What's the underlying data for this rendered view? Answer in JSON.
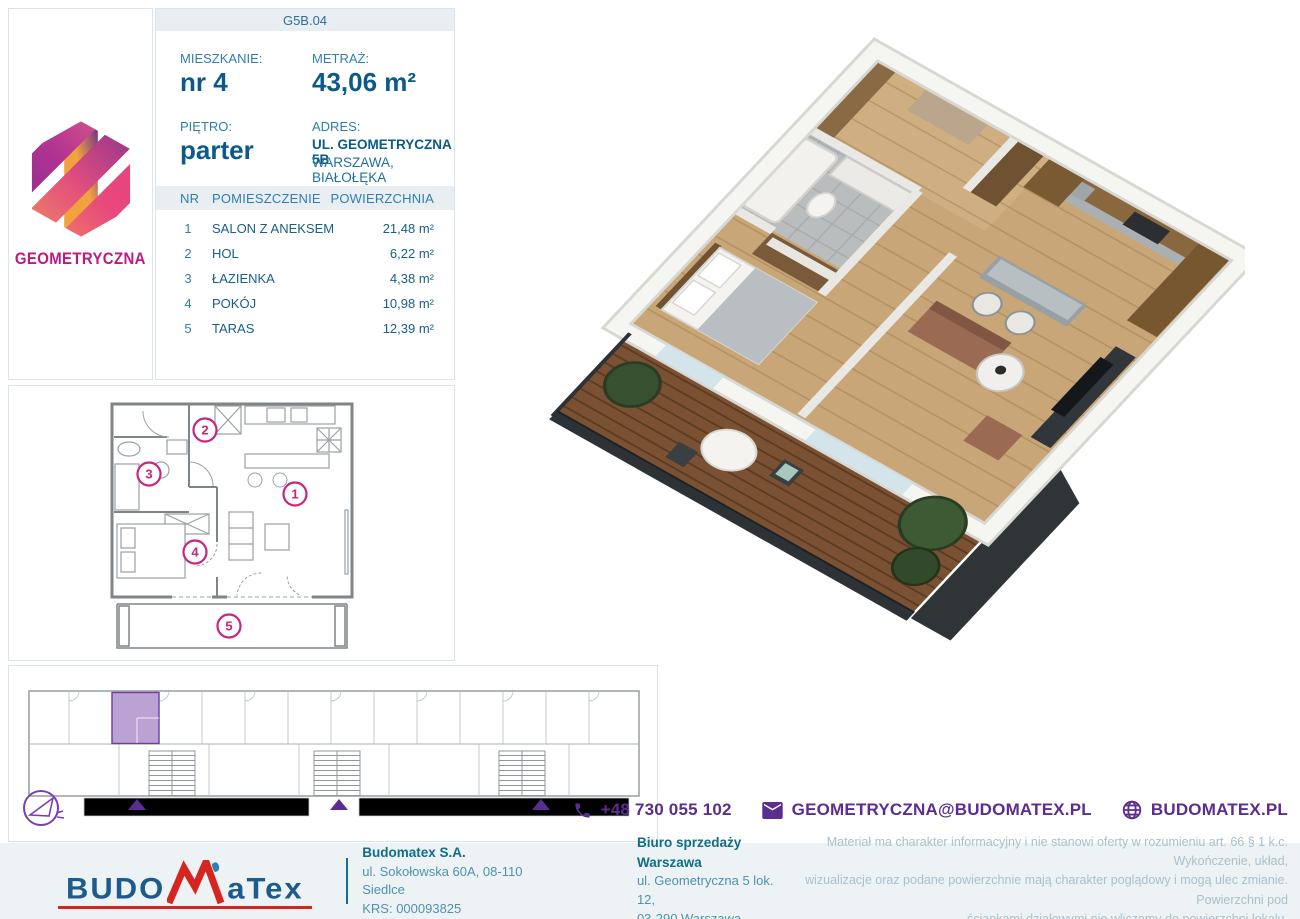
{
  "brand": {
    "name": "GEOMETRYCZNA"
  },
  "unit": {
    "code": "G5B.04",
    "apartment_label": "MIESZKANIE:",
    "apartment_value": "nr 4",
    "area_label": "METRAŻ:",
    "area_value": "43,06 m²",
    "floor_label": "PIĘTRO:",
    "floor_value": "parter",
    "address_label": "ADRES:",
    "address_line1": "UL. GEOMETRYCZNA 5B",
    "address_line2": "WARSZAWA, BIAŁOŁĘKA"
  },
  "rooms": {
    "headers": {
      "nr": "NR",
      "name": "POMIESZCZENIE",
      "area": "POWIERZCHNIA"
    },
    "rows": [
      {
        "nr": "1",
        "name": "SALON Z ANEKSEM",
        "area": "21,48 m²"
      },
      {
        "nr": "2",
        "name": "HOL",
        "area": "6,22 m²"
      },
      {
        "nr": "3",
        "name": "ŁAZIENKA",
        "area": "4,38 m²"
      },
      {
        "nr": "4",
        "name": "POKÓJ",
        "area": "10,98 m²"
      },
      {
        "nr": "5",
        "name": "TARAS",
        "area": "12,39 m²"
      }
    ]
  },
  "plan2d": {
    "markers": [
      "1",
      "2",
      "3",
      "4",
      "5"
    ]
  },
  "contact": {
    "phone": "+48 730 055 102",
    "email": "GEOMETRYCZNA@BUDOMATEX.PL",
    "website": "BUDOMATEX.PL"
  },
  "footer": {
    "logo_left": "BUDO",
    "logo_right": "aTex",
    "company_name": "Budomatex S.A.",
    "company_address": "ul. Sokołowska 60A, 08-110 Siedlce",
    "company_krs": "KRS: 000093825",
    "office_name": "Biuro sprzedaży Warszawa",
    "office_address1": "ul. Geometryczna 5 lok. 12,",
    "office_address2": "03-290 Warszawa",
    "disclaimer_line1": "Materiał ma charakter informacyjny i nie stanowi oferty w rozumieniu art. 66 § 1 k.c. Wykończenie, układ,",
    "disclaimer_line2": "wizualizacje oraz podane powierzchnie mają charakter poglądowy i mogą ulec zmianie. Powierzchni pod",
    "disclaimer_line3": "ściankami działowymi nie wliczamy do powierzchni lokalu."
  },
  "colors": {
    "accent_purple": "#5c2d91",
    "accent_magenta": "#c7257d",
    "blue_dark": "#0b5a89",
    "blue_mid": "#2f7fae",
    "footer_teal": "#16708d",
    "logo_red": "#d6251f"
  }
}
